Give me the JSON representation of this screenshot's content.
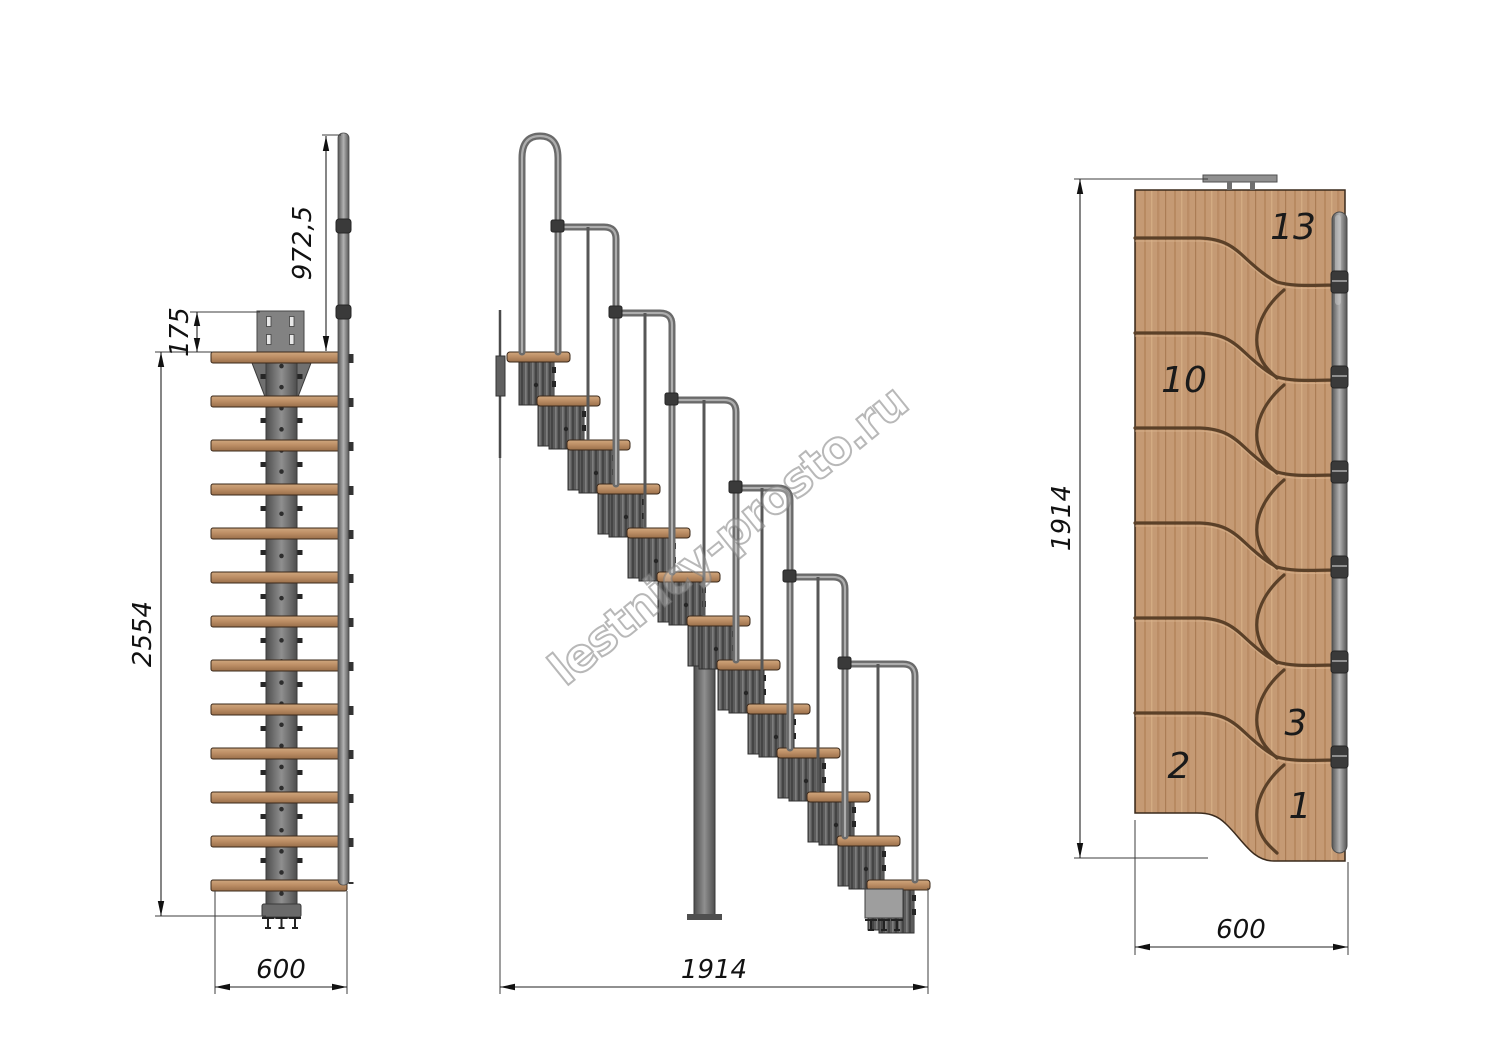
{
  "watermark": {
    "text": "lestnicy-prosto.ru"
  },
  "front": {
    "step_count": 13,
    "dimensions": {
      "rail_height": "972,5",
      "plate_offset": "175",
      "total_height": "2554",
      "width": "600"
    }
  },
  "side": {
    "step_count": 13,
    "dimensions": {
      "total_run": "1914"
    }
  },
  "plan": {
    "dimensions": {
      "length": "1914",
      "width": "600"
    },
    "tread_numbers": {
      "n13": "13",
      "n10": "10",
      "n3": "3",
      "n2": "2",
      "n1": "1"
    }
  },
  "colors": {
    "wood": "#c59a74",
    "wood_dark": "#9a6f4a",
    "groove": "#5a4028",
    "metal": "#6a6a6a",
    "metal_dark": "#3a3a3a",
    "dimension_line": "#222222",
    "watermark_outline": "#7d7d7d"
  }
}
